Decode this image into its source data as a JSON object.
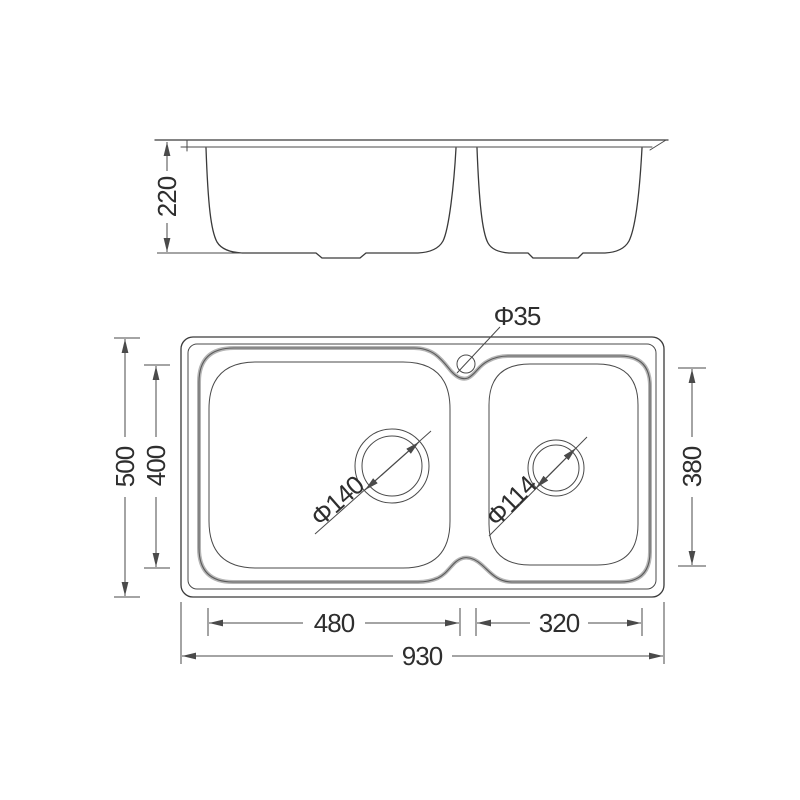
{
  "drawing": {
    "type": "technical-dimension-drawing",
    "subject": "double-bowl kitchen sink",
    "background_color": "#ffffff",
    "line_color": "#3a3a3a",
    "dimension_color": "#4a4a4a",
    "rim_band_color": "#b5b5b5"
  },
  "labels": {
    "bowl_depth": "220",
    "overall_depth": "500",
    "left_bowl_inner_depth": "400",
    "right_bowl_inner_depth": "380",
    "faucet_hole_diameter": "Φ35",
    "left_drain_diameter": "Φ140",
    "right_drain_diameter": "Φ114",
    "left_bowl_inner_width": "480",
    "right_bowl_inner_width": "320",
    "overall_width": "930"
  }
}
